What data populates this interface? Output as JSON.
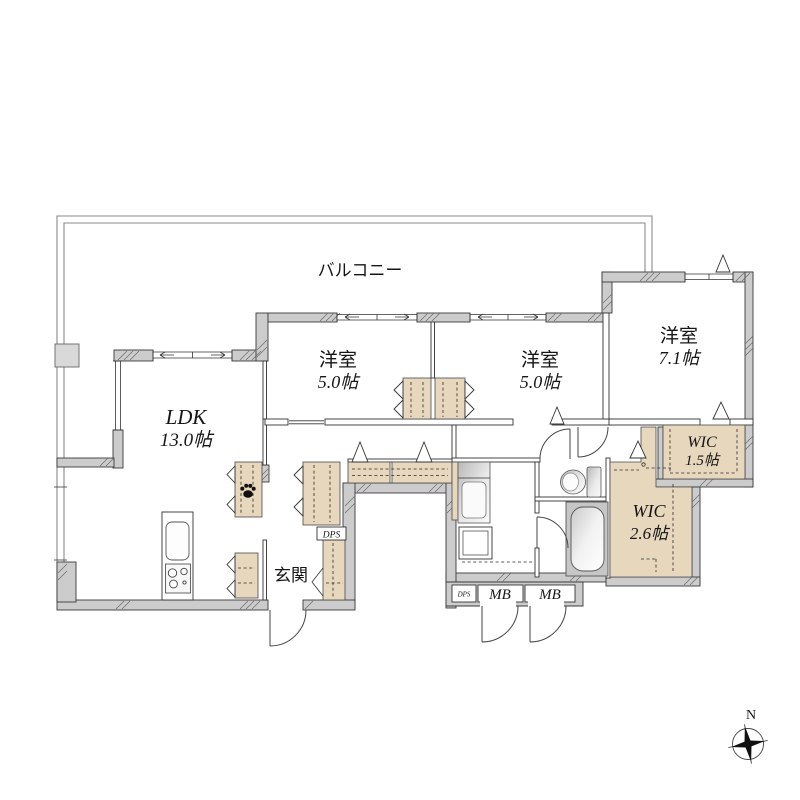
{
  "labels": {
    "balcony": "バルコニー",
    "ldk_name": "LDK",
    "ldk_size": "13.0帖",
    "room1_name": "洋室",
    "room1_size": "5.0帖",
    "room2_name": "洋室",
    "room2_size": "5.0帖",
    "room3_name": "洋室",
    "room3_size": "7.1帖",
    "wic1_name": "WIC",
    "wic1_size": "1.5帖",
    "wic2_name": "WIC",
    "wic2_size": "2.6帖",
    "genkan": "玄関",
    "dps_hall": "DPS",
    "dps_meter": "DPS",
    "mb1": "MB",
    "mb2": "MB",
    "compass_north": "N"
  },
  "colors": {
    "wall": "#cccccc",
    "beige": "#e7d7bd",
    "line": "#333333",
    "balline": "#8a8a8a",
    "paper": "#ffffff"
  }
}
